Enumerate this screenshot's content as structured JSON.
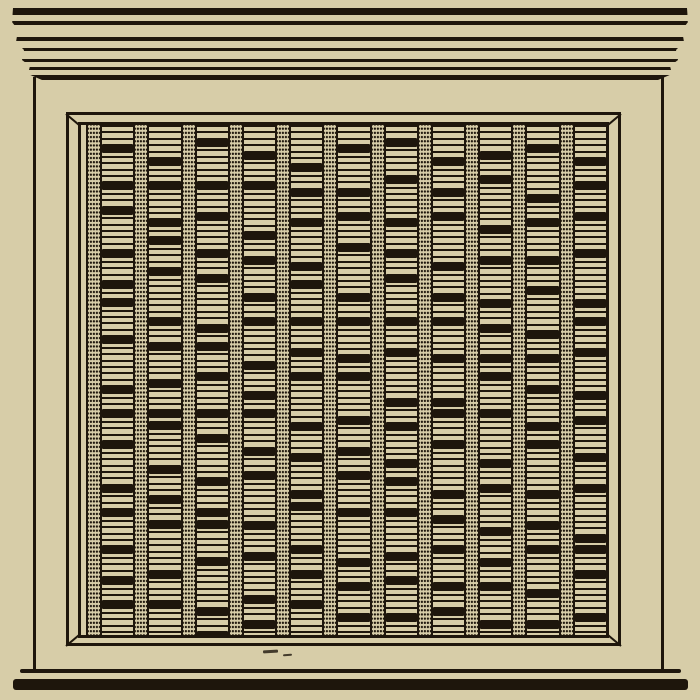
{
  "meta": {
    "subject": "woodcut engraving of a square cabinet front with cornice, beveled frame, and vertical perforated slats alternating with stacks of horizontal bars",
    "text_content": ""
  },
  "colors": {
    "paper": "#d7cda8",
    "ink": "#1e160c"
  },
  "cornice": {
    "lines": [
      {
        "top": 0,
        "height": 7
      },
      {
        "top": 13,
        "height": 4
      },
      {
        "top": 29,
        "height": 4
      },
      {
        "top": 40,
        "height": 3
      },
      {
        "top": 51,
        "height": 3
      },
      {
        "top": 59,
        "height": 3
      },
      {
        "top": 67,
        "height": 4.5
      }
    ]
  },
  "panel": {
    "column_count": 11,
    "fill_height": 545,
    "columns": [
      {
        "groups": [
          3,
          4,
          2,
          5,
          3,
          1,
          4,
          6,
          2,
          3,
          5,
          2,
          4,
          3,
          2,
          5
        ]
      },
      {
        "groups": [
          5,
          2,
          4,
          1,
          3,
          6,
          2,
          4,
          3,
          0,
          5,
          3,
          2,
          6,
          3,
          4
        ]
      },
      {
        "groups": [
          2,
          5,
          3,
          4,
          2,
          6,
          1,
          3,
          4,
          2,
          5,
          3,
          0,
          4,
          6,
          2
        ]
      },
      {
        "groups": [
          4,
          3,
          6,
          2,
          4,
          2,
          5,
          3,
          1,
          4,
          2,
          6,
          3,
          5,
          2,
          3
        ]
      },
      {
        "groups": [
          6,
          2,
          3,
          5,
          1,
          4,
          3,
          2,
          6,
          3,
          4,
          0,
          5,
          2,
          3,
          4
        ]
      },
      {
        "groups": [
          3,
          5,
          2,
          3,
          6,
          2,
          4,
          1,
          5,
          3,
          2,
          4,
          6,
          2,
          3,
          5
        ]
      },
      {
        "groups": [
          2,
          4,
          5,
          3,
          2,
          5,
          3,
          6,
          2,
          4,
          1,
          3,
          5,
          2,
          4,
          3
        ]
      },
      {
        "groups": [
          5,
          3,
          2,
          6,
          3,
          2,
          4,
          5,
          0,
          3,
          6,
          2,
          3,
          4,
          2,
          5
        ]
      },
      {
        "groups": [
          4,
          2,
          6,
          3,
          5,
          2,
          3,
          1,
          4,
          6,
          2,
          5,
          3,
          2,
          4,
          3
        ]
      },
      {
        "groups": [
          3,
          6,
          2,
          4,
          3,
          5,
          2,
          3,
          4,
          1,
          6,
          3,
          2,
          5,
          3,
          2
        ]
      },
      {
        "groups": [
          5,
          2,
          3,
          4,
          6,
          1,
          3,
          5,
          2,
          4,
          3,
          6,
          0,
          2,
          5,
          3
        ]
      }
    ]
  },
  "artifacts": {
    "dashes": [
      {
        "x": 263,
        "y": 650,
        "w": 15,
        "h": 2.5,
        "angle": -3
      },
      {
        "x": 283,
        "y": 654,
        "w": 9,
        "h": 2,
        "angle": -5
      }
    ]
  }
}
